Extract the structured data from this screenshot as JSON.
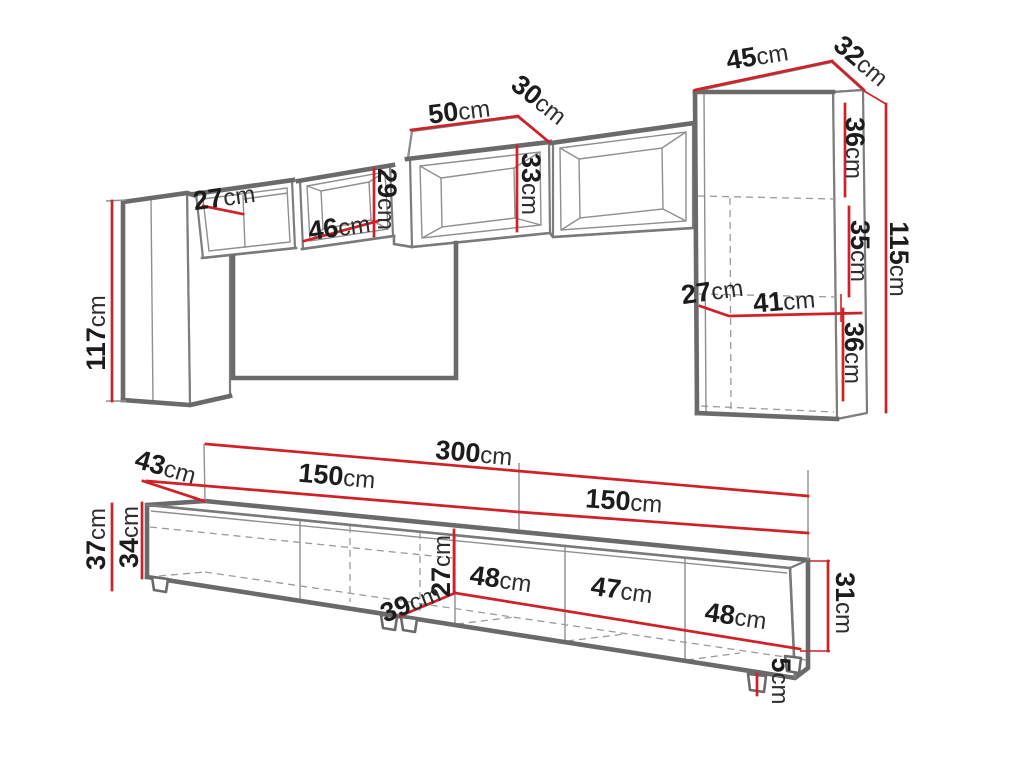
{
  "figure": {
    "type": "furniture-dimension-diagram",
    "unit": "cm",
    "parts": [
      "wall-unit-set",
      "tv-stand"
    ]
  },
  "colors": {
    "dimension_line": "#cf2127",
    "outline": "#6a6a6a",
    "text": "#1c1c1c",
    "background": "#ffffff"
  },
  "wall_unit": {
    "left_cabinet_height": {
      "value": "117",
      "unit": "cm"
    },
    "shelf_compartment_width": {
      "value": "27",
      "unit": "cm"
    },
    "open_box_width": {
      "value": "46",
      "unit": "cm"
    },
    "open_box_height": {
      "value": "29",
      "unit": "cm"
    },
    "top_box_width": {
      "value": "50",
      "unit": "cm"
    },
    "top_box_depth": {
      "value": "30",
      "unit": "cm"
    },
    "top_box_height": {
      "value": "33",
      "unit": "cm"
    },
    "right_cabinet_width": {
      "value": "45",
      "unit": "cm"
    },
    "right_cabinet_depth": {
      "value": "32",
      "unit": "cm"
    },
    "right_section_top": {
      "value": "36",
      "unit": "cm"
    },
    "right_section_middle": {
      "value": "35",
      "unit": "cm"
    },
    "right_section_bottom": {
      "value": "36",
      "unit": "cm"
    },
    "right_cabinet_height": {
      "value": "115",
      "unit": "cm"
    },
    "right_inner_depth": {
      "value": "27",
      "unit": "cm"
    },
    "right_inner_width": {
      "value": "41",
      "unit": "cm"
    }
  },
  "tv_stand": {
    "total_width": {
      "value": "300",
      "unit": "cm"
    },
    "left_half_width": {
      "value": "150",
      "unit": "cm"
    },
    "right_half_width": {
      "value": "150",
      "unit": "cm"
    },
    "depth": {
      "value": "43",
      "unit": "cm"
    },
    "total_height_with_feet": {
      "value": "37",
      "unit": "cm"
    },
    "body_height": {
      "value": "34",
      "unit": "cm"
    },
    "inner_height": {
      "value": "27",
      "unit": "cm"
    },
    "diagonal_depth": {
      "value": "39",
      "unit": "cm"
    },
    "door1_width": {
      "value": "48",
      "unit": "cm"
    },
    "door2_width": {
      "value": "47",
      "unit": "cm"
    },
    "door3_width": {
      "value": "48",
      "unit": "cm"
    },
    "right_end_height": {
      "value": "31",
      "unit": "cm"
    },
    "foot_height": {
      "value": "5",
      "unit": "cm"
    }
  }
}
